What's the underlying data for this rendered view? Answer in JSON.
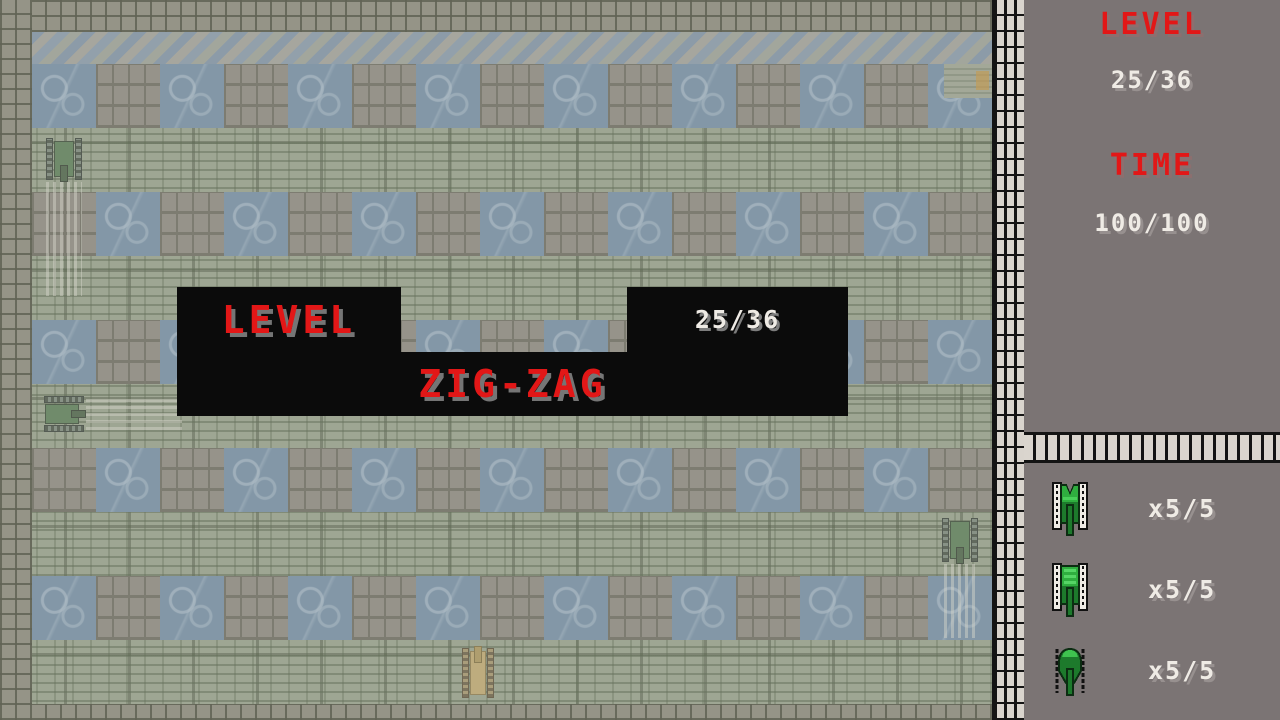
{
  "banner": {
    "level_label": "LEVEL",
    "level_value": "25/36",
    "level_name": "ZIG-ZAG"
  },
  "sidebar": {
    "level_label": "LEVEL",
    "level_value": "25/36",
    "time_label": "TIME",
    "time_value": "100/100",
    "tanks": [
      {
        "icon": "enemy-tank-pointed",
        "count": "x5/5"
      },
      {
        "icon": "enemy-tank-striped",
        "count": "x5/5"
      },
      {
        "icon": "enemy-tank-dome",
        "count": "x5/5"
      }
    ]
  },
  "field": {
    "origin_x": 32,
    "tile": 64,
    "cols": 15,
    "rows": [
      {
        "y": 64,
        "start": "water"
      },
      {
        "y": 192,
        "start": "brick"
      },
      {
        "y": 320,
        "start": "water"
      },
      {
        "y": 448,
        "start": "brick"
      },
      {
        "y": 576,
        "start": "water"
      }
    ],
    "tanks": [
      {
        "color": "green",
        "dir": "down",
        "x": 46,
        "y": 136,
        "w": 36,
        "h": 46
      },
      {
        "color": "green",
        "dir": "right",
        "x": 42,
        "y": 396,
        "w": 44,
        "h": 36
      },
      {
        "color": "green",
        "dir": "down",
        "x": 942,
        "y": 516,
        "w": 36,
        "h": 48
      },
      {
        "color": "yellow",
        "dir": "up",
        "x": 462,
        "y": 646,
        "w": 32,
        "h": 54
      }
    ],
    "trails": [
      {
        "dir": "v",
        "x": 46,
        "y": 182,
        "w": 36,
        "h": 114
      },
      {
        "dir": "h",
        "x": 86,
        "y": 398,
        "w": 96,
        "h": 32
      },
      {
        "dir": "v",
        "x": 944,
        "y": 564,
        "w": 34,
        "h": 74
      }
    ]
  },
  "colors": {
    "accent_red": "#e21717",
    "hud_text_white": "#efebe5",
    "banner_bg": "#0b0b0b",
    "water": "#7691a9",
    "sidebar_bg": "#7b7474",
    "wall_brick": "#d9d4cd",
    "enemy_green": "#2fae3f",
    "player_yellow": "#c4ad72"
  }
}
